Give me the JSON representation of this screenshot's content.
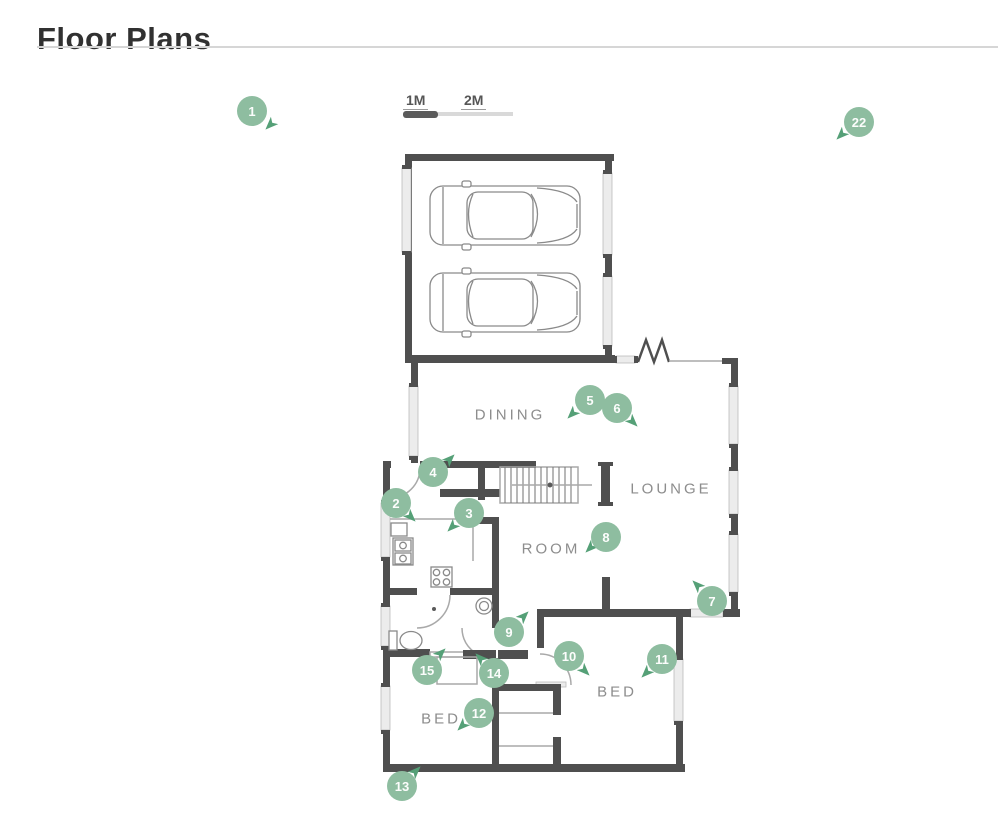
{
  "page": {
    "heading": "Floor Plans"
  },
  "scale_bar": {
    "labels": [
      "1M",
      "2M"
    ]
  },
  "floor_plan": {
    "room_labels": [
      {
        "text": "DINING",
        "x": 510,
        "y": 415
      },
      {
        "text": "LOUNGE",
        "x": 671,
        "y": 489
      },
      {
        "text": "ROOM",
        "x": 551,
        "y": 549
      },
      {
        "text": "BED",
        "x": 617,
        "y": 692
      },
      {
        "text": "BED",
        "x": 441,
        "y": 719
      }
    ],
    "markers": [
      {
        "number": "1",
        "x": 252,
        "y": 111,
        "ax": 270,
        "ay": 125,
        "rot": 135
      },
      {
        "number": "2",
        "x": 396,
        "y": 503,
        "ax": 411,
        "ay": 517,
        "rot": 45
      },
      {
        "number": "3",
        "x": 469,
        "y": 513,
        "ax": 452,
        "ay": 527,
        "rot": 135
      },
      {
        "number": "4",
        "x": 433,
        "y": 472,
        "ax": 450,
        "ay": 459,
        "rot": -45
      },
      {
        "number": "5",
        "x": 590,
        "y": 400,
        "ax": 572,
        "ay": 414,
        "rot": 135
      },
      {
        "number": "6",
        "x": 617,
        "y": 408,
        "ax": 633,
        "ay": 422,
        "rot": 45
      },
      {
        "number": "7",
        "x": 712,
        "y": 601,
        "ax": 697,
        "ay": 585,
        "rot": 225
      },
      {
        "number": "8",
        "x": 606,
        "y": 537,
        "ax": 590,
        "ay": 548,
        "rot": 135
      },
      {
        "number": "9",
        "x": 509,
        "y": 632,
        "ax": 524,
        "ay": 616,
        "rot": -45
      },
      {
        "number": "10",
        "x": 569,
        "y": 656,
        "ax": 585,
        "ay": 671,
        "rot": 45
      },
      {
        "number": "11",
        "x": 662,
        "y": 659,
        "ax": 646,
        "ay": 673,
        "rot": 135
      },
      {
        "number": "12",
        "x": 479,
        "y": 713,
        "ax": 462,
        "ay": 726,
        "rot": 135
      },
      {
        "number": "13",
        "x": 402,
        "y": 786,
        "ax": 416,
        "ay": 771,
        "rot": -45
      },
      {
        "number": "14",
        "x": 494,
        "y": 673,
        "ax": 480,
        "ay": 658,
        "rot": 225
      },
      {
        "number": "15",
        "x": 427,
        "y": 670,
        "ax": 441,
        "ay": 653,
        "rot": -45
      },
      {
        "number": "22",
        "x": 859,
        "y": 122,
        "ax": 841,
        "ay": 135,
        "rot": 135
      }
    ],
    "colors": {
      "marker": "#8ebda0",
      "marker_text": "#fcfdfc",
      "arrow": "#55a077",
      "wall": "#4f4f4f",
      "thin_line": "#a9a9a9",
      "window_fill": "#ececec",
      "label_text": "#8d8d8d",
      "title_text": "#313131",
      "divider": "#d6d6d6",
      "scale_dark": "#5b5b5b",
      "scale_light": "#d9d9d9",
      "scale_text": "#565656"
    }
  }
}
